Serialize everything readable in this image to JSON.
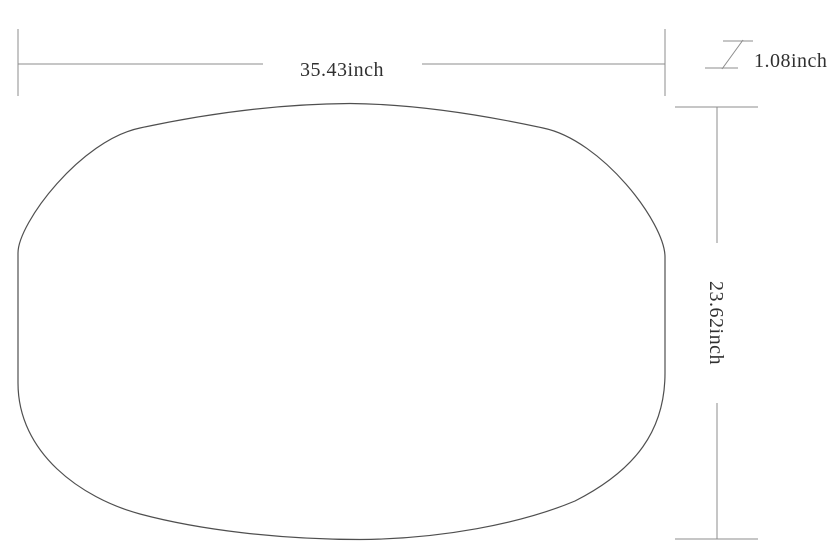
{
  "diagram": {
    "type": "technical-dimension-drawing",
    "subject": "rounded-oval-plate-outline",
    "background_color": "#ffffff",
    "dimension_line_color": "#8c8c8c",
    "shape_outline_color": "#4f4f4f",
    "label_color": "#303030",
    "dimensions": {
      "width": {
        "label": "35.43inch",
        "value": 35.43,
        "unit": "inch",
        "orientation": "horizontal"
      },
      "height": {
        "label": "23.62inch",
        "value": 23.62,
        "unit": "inch",
        "orientation": "vertical"
      },
      "thickness": {
        "label": "1.08inch",
        "value": 1.08,
        "unit": "inch",
        "orientation": "thickness-symbol"
      }
    }
  }
}
